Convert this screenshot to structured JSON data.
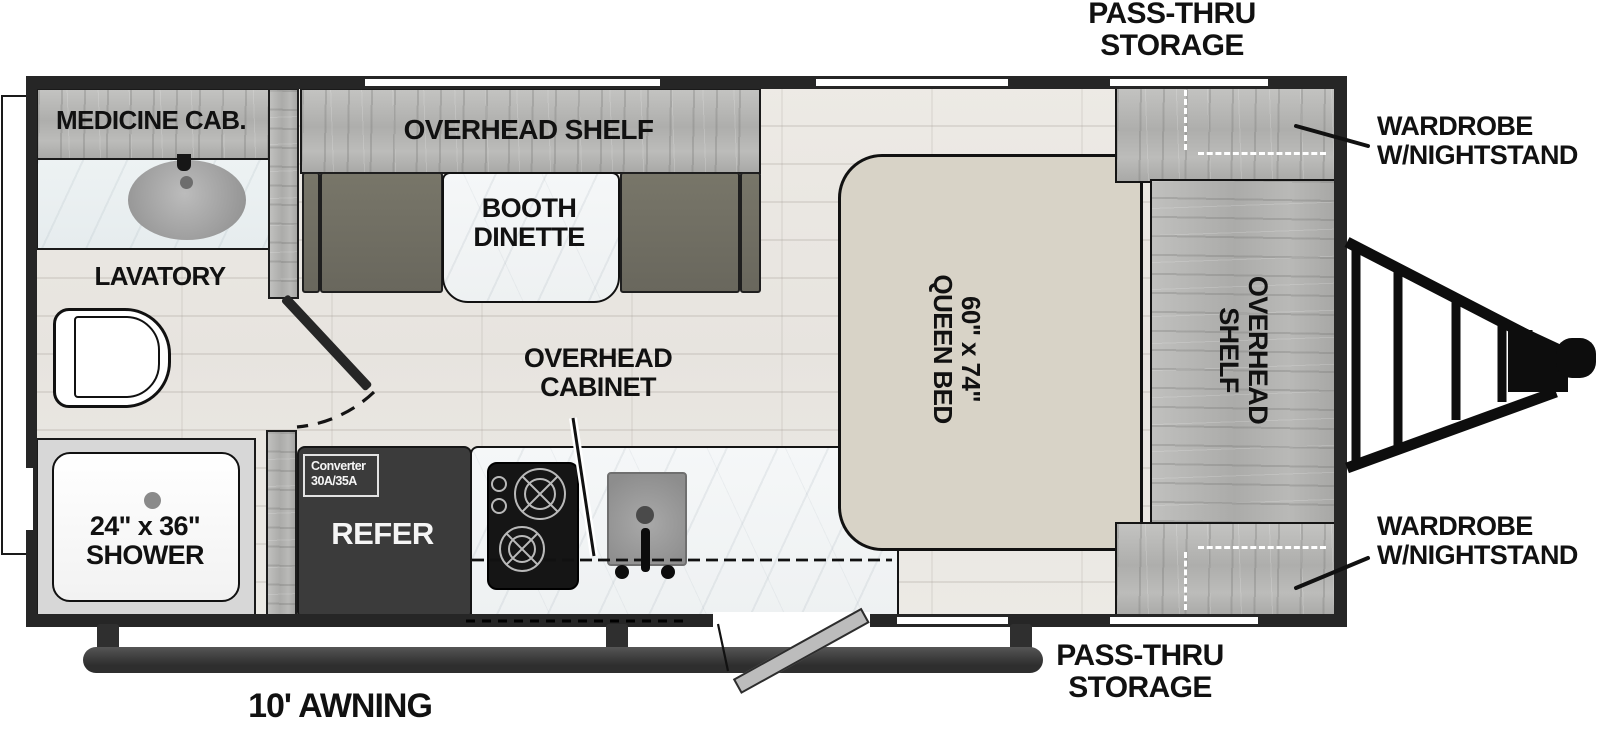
{
  "title": "Travel trailer floor plan",
  "colors": {
    "wall": "#262626",
    "wood_cabinet": "#b5b5b3",
    "floor": "#eae7e2",
    "bench": "#6f6d63",
    "bed": "#d8d3c7",
    "marble": "#f3f5f6",
    "refer": "#3b3b3b",
    "awning_bar": "#383838",
    "label_text": "#111111"
  },
  "labels": {
    "pass_thru_top": {
      "line1": "PASS-THRU",
      "line2": "STORAGE"
    },
    "pass_thru_bottom": {
      "line1": "PASS-THRU",
      "line2": "STORAGE"
    },
    "wardrobe_top": {
      "line1": "WARDROBE",
      "line2": "W/NIGHTSTAND"
    },
    "wardrobe_bottom": {
      "line1": "WARDROBE",
      "line2": "W/NIGHTSTAND"
    },
    "medicine_cab": "MEDICINE CAB.",
    "lavatory": "LAVATORY",
    "shower": {
      "line1": "24\" x 36\"",
      "line2": "SHOWER"
    },
    "refer": "REFER",
    "converter": {
      "line1": "Converter",
      "line2": "30A/35A"
    },
    "overhead_cabinet": {
      "line1": "OVERHEAD",
      "line2": "CABINET"
    },
    "overhead_shelf_dinette": "OVERHEAD SHELF",
    "booth_dinette": {
      "line1": "BOOTH",
      "line2": "DINETTE"
    },
    "queen_bed": {
      "line1": "60\" x 74\"",
      "line2": "QUEEN BED"
    },
    "overhead_shelf_bedside": {
      "line1": "OVERHEAD",
      "line2": "SHELF"
    },
    "awning": "10' AWNING"
  }
}
